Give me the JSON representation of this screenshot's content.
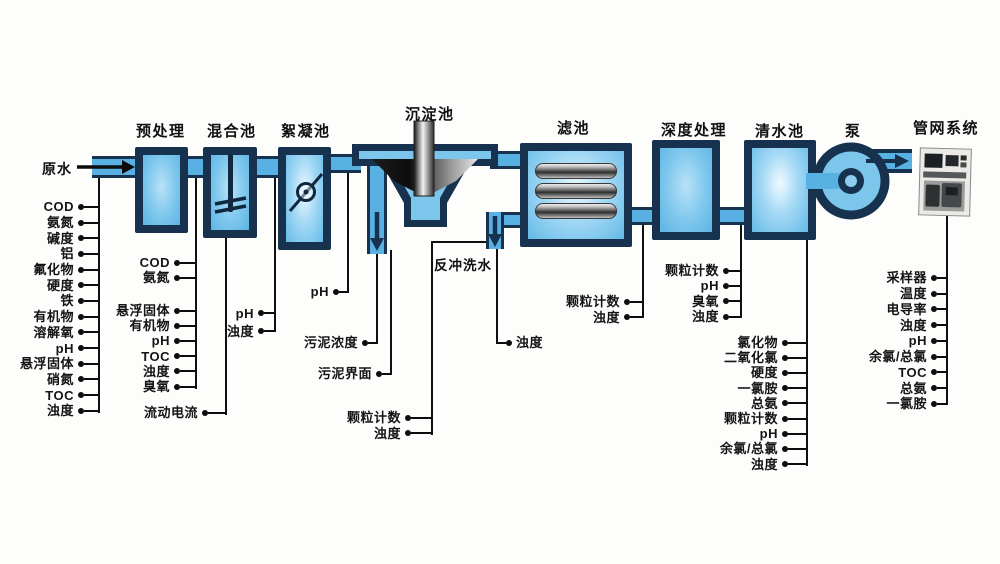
{
  "stages": [
    {
      "label": "预处理"
    },
    {
      "label": "混合池"
    },
    {
      "label": "絮凝池"
    },
    {
      "label": "沉淀池"
    },
    {
      "label": "滤池"
    },
    {
      "label": "深度处理"
    },
    {
      "label": "清水池"
    },
    {
      "label": "泵"
    },
    {
      "label": "管网系统"
    }
  ],
  "flow_labels": {
    "raw_water": "原水",
    "backwash_water": "反冲洗水"
  },
  "sensors": {
    "raw_water": [
      "COD",
      "氨氮",
      "碱度",
      "铝",
      "氟化物",
      "硬度",
      "铁",
      "有机物",
      "溶解氧",
      "pH",
      "悬浮固体",
      "硝氮",
      "TOC",
      "浊度"
    ],
    "pretreatment_a": [
      "COD",
      "氨氮"
    ],
    "pretreatment_b": [
      "悬浮固体",
      "有机物",
      "pH",
      "TOC",
      "浊度",
      "臭氧"
    ],
    "mixing_stream": [
      "流动电流"
    ],
    "mixing": [
      "pH",
      "浊度"
    ],
    "flocculation": [
      "pH"
    ],
    "sludge_concentration": [
      "污泥浓度"
    ],
    "sludge_interface": [
      "污泥界面"
    ],
    "backwash": [
      "颗粒计数",
      "浊度"
    ],
    "settled_water": [
      "浊度"
    ],
    "filter": [
      "颗粒计数",
      "浊度"
    ],
    "advanced_treatment": [
      "颗粒计数",
      "pH",
      "臭氧",
      "浊度"
    ],
    "clear_water": [
      "氯化物",
      "二氧化氯",
      "硬度",
      "一氯胺",
      "总氨",
      "颗粒计数",
      "pH",
      "余氯/总氯",
      "浊度"
    ],
    "network": [
      "采样器",
      "温度",
      "电导率",
      "浊度",
      "pH",
      "余氯/总氯",
      "TOC",
      "总氨",
      "一氯胺"
    ]
  },
  "colors": {
    "pipe_blue": "#58b1e2",
    "tank_fill": "#7cc6ec",
    "tank_border": "#16324f",
    "connector_line": "#101010"
  }
}
